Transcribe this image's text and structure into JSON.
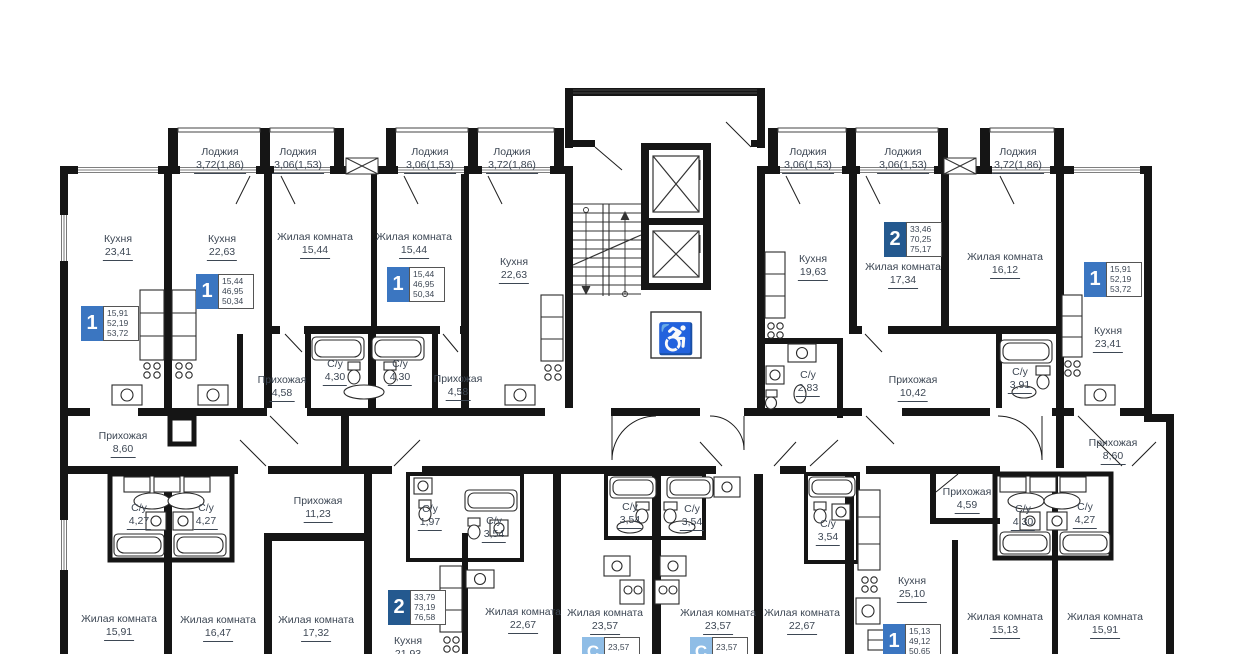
{
  "colors": {
    "wall": "#151515",
    "label": "#3d4754",
    "badge_one": "#3b76c1",
    "badge_two": "#24598f",
    "badge_studio": "#8fbde6"
  },
  "icons": {
    "wheelchair": "♿"
  },
  "rooms": [
    {
      "name": "Лоджия",
      "area": "3,72(1,86)"
    },
    {
      "name": "Лоджия",
      "area": "3,06(1,53)"
    },
    {
      "name": "Лоджия",
      "area": "3,06(1,53)"
    },
    {
      "name": "Лоджия",
      "area": "3,72(1,86)"
    },
    {
      "name": "Лоджия",
      "area": "3,06(1,53)"
    },
    {
      "name": "Лоджия",
      "area": "3,06(1,53)"
    },
    {
      "name": "Лоджия",
      "area": "3,72(1,86)"
    },
    {
      "name": "Кухня",
      "area": "23,41"
    },
    {
      "name": "Кухня",
      "area": "22,63"
    },
    {
      "name": "Жилая комната",
      "area": "15,44"
    },
    {
      "name": "Жилая комната",
      "area": "15,44"
    },
    {
      "name": "Кухня",
      "area": "22,63"
    },
    {
      "name": "Кухня",
      "area": "19,63"
    },
    {
      "name": "Жилая комната",
      "area": "17,34"
    },
    {
      "name": "Жилая комната",
      "area": "16,12"
    },
    {
      "name": "Кухня",
      "area": "23,41"
    },
    {
      "name": "Прихожая",
      "area": "4,58"
    },
    {
      "name": "С/у",
      "area": "4,30"
    },
    {
      "name": "С/у",
      "area": "4,30"
    },
    {
      "name": "Прихожая",
      "area": "4,58"
    },
    {
      "name": "Прихожая",
      "area": "8,60"
    },
    {
      "name": "С/у",
      "area": "2,83"
    },
    {
      "name": "Прихожая",
      "area": "10,42"
    },
    {
      "name": "С/у",
      "area": "3,91"
    },
    {
      "name": "Прихожая",
      "area": "8,60"
    },
    {
      "name": "С/у",
      "area": "4,27"
    },
    {
      "name": "С/у",
      "area": "4,27"
    },
    {
      "name": "Прихожая",
      "area": "11,23"
    },
    {
      "name": "Жилая комната",
      "area": "15,91"
    },
    {
      "name": "Жилая комната",
      "area": "16,47"
    },
    {
      "name": "Жилая комната",
      "area": "17,32"
    },
    {
      "name": "С/у",
      "area": "1,97"
    },
    {
      "name": "С/у",
      "area": "3,54"
    },
    {
      "name": "Кухня",
      "area": "21,93"
    },
    {
      "name": "Жилая комната",
      "area": "22,67"
    },
    {
      "name": "С/у",
      "area": "3,54"
    },
    {
      "name": "С/у",
      "area": "3,54"
    },
    {
      "name": "Жилая комната",
      "area": "23,57"
    },
    {
      "name": "Жилая комната",
      "area": "23,57"
    },
    {
      "name": "Жилая комната",
      "area": "22,67"
    },
    {
      "name": "С/у",
      "area": "3,54"
    },
    {
      "name": "Прихожая",
      "area": "4,59"
    },
    {
      "name": "С/у",
      "area": "4,30"
    },
    {
      "name": "С/у",
      "area": "4,27"
    },
    {
      "name": "Кухня",
      "area": "25,10"
    },
    {
      "name": "Жилая комната",
      "area": "15,13"
    },
    {
      "name": "Жилая комната",
      "area": "15,91"
    }
  ],
  "apartments": [
    {
      "number": "1",
      "areas": [
        "15,91",
        "52,19",
        "53,72"
      ],
      "color": "#3b76c1"
    },
    {
      "number": "1",
      "areas": [
        "15,44",
        "46,95",
        "50,34"
      ],
      "color": "#3b76c1"
    },
    {
      "number": "1",
      "areas": [
        "15,44",
        "46,95",
        "50,34"
      ],
      "color": "#3b76c1"
    },
    {
      "number": "2",
      "areas": [
        "33,46",
        "70,25",
        "75,17"
      ],
      "color": "#24598f"
    },
    {
      "number": "1",
      "areas": [
        "15,91",
        "52,19",
        "53,72"
      ],
      "color": "#3b76c1"
    },
    {
      "number": "2",
      "areas": [
        "33,79",
        "73,19",
        "76,58"
      ],
      "color": "#24598f"
    },
    {
      "number": "1",
      "areas": [
        "15,13",
        "49,12",
        "50,65"
      ],
      "color": "#3b76c1"
    },
    {
      "number": "С",
      "areas": [
        "23,57",
        "27,11"
      ],
      "color": "#8fbde6"
    },
    {
      "number": "С",
      "areas": [
        "23,57",
        "27,11"
      ],
      "color": "#8fbde6"
    }
  ]
}
